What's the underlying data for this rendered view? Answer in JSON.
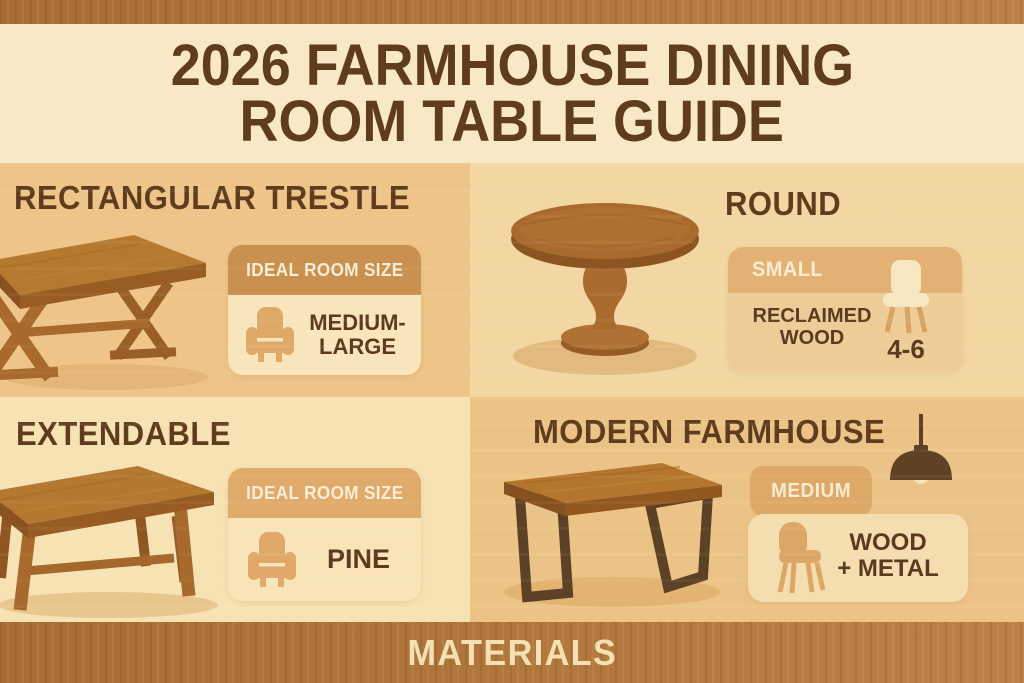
{
  "poster": {
    "title_line1": "2026 FARMHOUSE DINING",
    "title_line2": "ROOM TABLE GUIDE",
    "footer_label": "MATERIALS"
  },
  "colors": {
    "wood_band": "#b0763c",
    "header_band_bg": "#f8e8c5",
    "title_text": "#5e3c1d",
    "quadrant_dark_tan": "#eec489",
    "quadrant_mid_tan": "#f2d7a3",
    "quadrant_light_cream": "#f7e2b4",
    "card_header_caramel": "#c9904f",
    "card_header_tan": "#e0aa6a",
    "card_body_cream": "#f8e5bc",
    "badge_tan": "#dea966",
    "dark_brown_text": "#5c3a1f",
    "cream_text": "#f8ecd0",
    "table_wood": "#b4782f",
    "metal_leg": "#5c4126"
  },
  "quadrants": [
    {
      "id": "rectangular-trestle",
      "heading": "RECTANGULAR TRESTLE",
      "illustration": "trestle-table-illustration",
      "card": {
        "header": "IDEAL ROOM SIZE",
        "icon": "armchair-icon",
        "value_line1": "MEDIUM-",
        "value_line2": "LARGE"
      }
    },
    {
      "id": "round",
      "heading": "ROUND",
      "illustration": "round-pedestal-table-illustration",
      "card": {
        "header": "SMALL",
        "icon": "dining-chair-icon",
        "value_line1": "RECLAIMED",
        "value_line2": "WOOD",
        "seating": "4-6"
      }
    },
    {
      "id": "extendable",
      "heading": "EXTENDABLE",
      "illustration": "extendable-table-illustration",
      "card": {
        "header": "IDEAL ROOM SIZE",
        "icon": "armchair-icon",
        "value": "PINE"
      }
    },
    {
      "id": "modern-farmhouse",
      "heading": "MODERN FARMHOUSE",
      "illustration": "modern-farmhouse-table-illustration",
      "decor_icon": "pendant-light-icon",
      "card": {
        "header": "MEDIUM",
        "icon": "side-chair-icon",
        "value_line1": "WOOD",
        "value_line2": "+ METAL"
      }
    }
  ]
}
